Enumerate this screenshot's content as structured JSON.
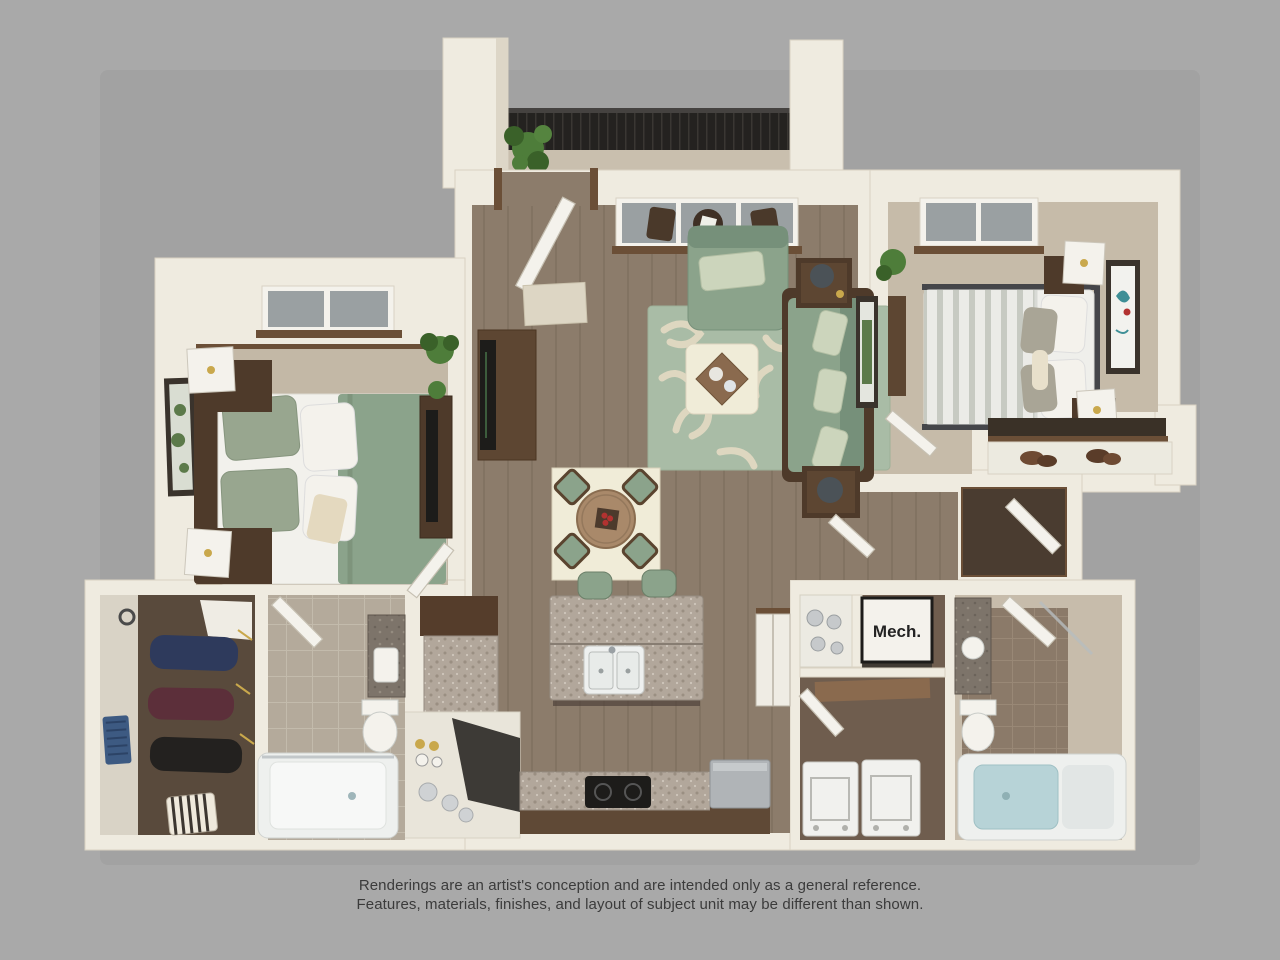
{
  "labels": {
    "mech": "Mech."
  },
  "disclaimer": {
    "line1": "Renderings are an artist's conception and are intended only as a general reference.",
    "line2": "Features, materials, finishes, and layout of subject unit may be different than shown."
  },
  "colors": {
    "bg": "#a9a9a9",
    "shadow": "#9a9a9a",
    "wall": "#efebe0",
    "wallEdge": "#d9d2c2",
    "wallShade": "#ddd6c7",
    "wood": "#8c7c6b",
    "carpet1": "#c3b8a6",
    "carpet2": "#c6bba9",
    "closetFloor": "#594a3c",
    "hallClosetFloor": "#4a3c30",
    "laundryFloor": "#6f5d4e",
    "tileBeige": "#b4aa9b",
    "tileBeigeLine": "#c3bbac",
    "tileBrown": "#8b7a69",
    "tileBrownLine": "#998876",
    "sage": "#8ba38b",
    "sageDark": "#76907a",
    "sageLight": "#ccd5bc",
    "rugGreen": "#a9bca6",
    "rugCream": "#ded7c0",
    "cream": "#f0ecd8",
    "trimBrown": "#6b4f37",
    "furnDark": "#4e3a2a",
    "furnMed": "#8a6a4e",
    "furnLight": "#a9896a",
    "granite": "#b2a79b",
    "graniteDot": "#9a8f82",
    "graniteDark": "#7d746a",
    "black": "#1d1c1a",
    "railing": "#242220",
    "white": "#f4f2ec",
    "glass": "#9aa0a2",
    "tubBlue": "#b7d3d7",
    "appliance": "#b0b4b7",
    "plant": "#4e7d3a",
    "plantDark": "#3a6129",
    "gold": "#c9a84c",
    "red": "#b23230",
    "navy": "#2e3a5c",
    "maroon": "#5c2f3a",
    "clothDark": "#23211f",
    "toteBlue": "#3d5a82",
    "artGreen": "#5c7a4a",
    "teal": "#3e8f96",
    "text": "#3b3b3b"
  }
}
